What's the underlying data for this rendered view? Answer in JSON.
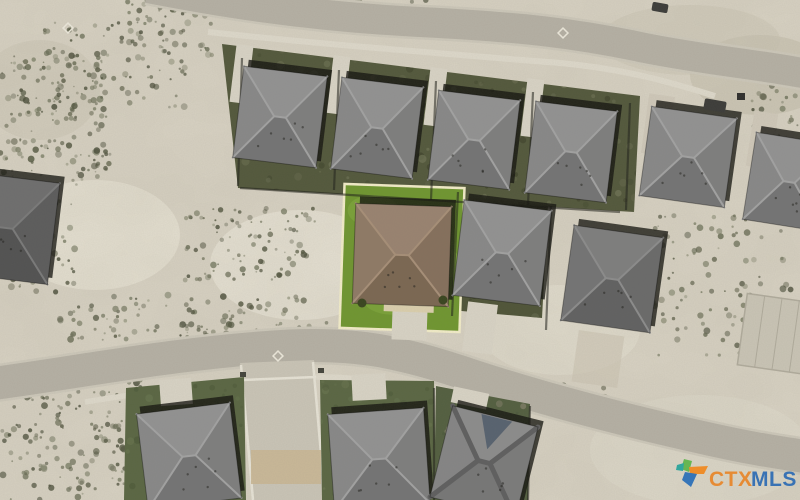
{
  "watermark": {
    "ctx": "CTX",
    "mls": "MLS",
    "ctx_color": "#e8862a",
    "mls_color": "#2e6cb4",
    "logo": {
      "green": "#5fb54a",
      "orange": "#f0891f",
      "blue": "#2a6fb8",
      "teal": "#27a39b"
    }
  },
  "palette": {
    "sand": "#d8d2c3",
    "road": "#b5b0a4",
    "road_edge": "#ccc7b9",
    "sidewalk": "#ddd8ca",
    "driveway": "#d8d3c5",
    "patio": "#dbcfad",
    "side_street": "#c9c4b6",
    "side_street_dirt": "#c9b795",
    "fence": "#20201a",
    "shadow": "#14140f",
    "slab": "#c9c4b5",
    "slab_line": "#b0ab9c",
    "lot_outline": "#f2ecc8",
    "lawn_highlight": "#6f9630",
    "lawn_highlight_light": "#84ab3f",
    "scrub_colors": [
      "#6b6e57",
      "#575a44",
      "#7a7d65",
      "#4b4e3a"
    ],
    "roofs": {
      "gray": {
        "n": "#929292",
        "e": "#7e7e7e",
        "s": "#747474",
        "w": "#888888",
        "ridge": "#a2a2a2",
        "ridge_w": 2
      },
      "brown": {
        "n": "#998370",
        "e": "#85705c",
        "s": "#7b6752",
        "w": "#8f7a66",
        "ridge": "#a78f78",
        "ridge_w": 2
      },
      "dark": {
        "n": "#6e6e6e",
        "e": "#5c5c5c",
        "s": "#525252",
        "w": "#666666",
        "ridge": "#7a7a7a",
        "ridge_w": 2
      },
      "dark2": {
        "n": "#7e7e7e",
        "e": "#6a6a6a",
        "s": "#616161",
        "w": "#747474",
        "ridge": "#8c8c8c",
        "ridge_w": 2
      },
      "b3": {
        "n": "#8c8c8c",
        "e": "#7b7b7b",
        "s": "#777777",
        "w": "#858585",
        "ridge": "#5f5f5f",
        "ridge_w": 5
      }
    }
  },
  "scene": {
    "shadow_offset": {
      "dx": 4,
      "dy": -7
    },
    "sand_patches": [
      {
        "cx": 95,
        "cy": 235,
        "rx": 85,
        "ry": 55,
        "fill": "#e5e0d2",
        "op": 0.9
      },
      {
        "cx": 300,
        "cy": 265,
        "rx": 90,
        "ry": 55,
        "fill": "#e8e3d5",
        "op": 0.85
      },
      {
        "cx": 430,
        "cy": 120,
        "rx": 60,
        "ry": 35,
        "fill": "#e0dbcd",
        "op": 0.6
      },
      {
        "cx": 690,
        "cy": 40,
        "rx": 90,
        "ry": 35,
        "fill": "#cfc9b9",
        "op": 0.8
      },
      {
        "cx": 760,
        "cy": 75,
        "rx": 70,
        "ry": 40,
        "fill": "#c8c1af",
        "op": 0.7
      },
      {
        "cx": 700,
        "cy": 450,
        "rx": 110,
        "ry": 55,
        "fill": "#ddd8c9",
        "op": 0.85
      },
      {
        "cx": 560,
        "cy": 330,
        "rx": 80,
        "ry": 45,
        "fill": "#e2ddcf",
        "op": 0.7
      },
      {
        "cx": 40,
        "cy": 90,
        "rx": 60,
        "ry": 50,
        "fill": "#cdc7b6",
        "op": 0.6
      }
    ],
    "scrub_clusters": [
      {
        "x": 125,
        "y": 0,
        "w": 95,
        "h": 55,
        "n": 55
      },
      {
        "x": 35,
        "y": 22,
        "w": 150,
        "h": 88,
        "n": 90
      },
      {
        "x": 0,
        "y": 55,
        "w": 110,
        "h": 130,
        "n": 160
      },
      {
        "x": 0,
        "y": 180,
        "w": 75,
        "h": 115,
        "n": 65
      },
      {
        "x": 0,
        "y": 378,
        "w": 150,
        "h": 122,
        "n": 160
      },
      {
        "x": 55,
        "y": 295,
        "w": 250,
        "h": 45,
        "n": 85
      },
      {
        "x": 185,
        "y": 208,
        "w": 130,
        "h": 72,
        "n": 95
      },
      {
        "x": 180,
        "y": 322,
        "w": 170,
        "h": 24,
        "n": 50
      },
      {
        "x": 640,
        "y": 215,
        "w": 155,
        "h": 145,
        "n": 115
      },
      {
        "x": 250,
        "y": 0,
        "w": 190,
        "h": 12,
        "n": 28
      },
      {
        "x": 752,
        "y": 84,
        "w": 46,
        "h": 52,
        "n": 26
      },
      {
        "x": 540,
        "y": 385,
        "w": 70,
        "h": 40,
        "n": 25
      }
    ],
    "roads": {
      "top": {
        "d": "M 148,-12 C 210,0 300,16 420,22 C 520,27 575,33 645,48 C 705,60 755,64 808,74",
        "w": 30
      },
      "top_sidewalk": {
        "d": "M 208,32 C 330,45 460,55 560,63 C 625,69 670,82 715,96",
        "w": 6
      },
      "bottom": {
        "d": "M -10,384 C 80,372 180,352 290,346 C 360,343 400,352 470,375 C 540,398 620,419 700,437 C 752,449 782,453 808,457",
        "w": 33
      },
      "bottom_sidewalk": {
        "d": "M 85,402 C 170,388 250,379 320,377 C 380,377 432,390 478,406",
        "w": 5.5
      }
    },
    "side_street": {
      "points": "240,363 314,360 326,500 252,500",
      "edge_left": [
        241,
        365,
        253,
        500
      ],
      "edge_right": [
        313,
        362,
        325,
        500
      ],
      "crossing": [
        242,
        380,
        316,
        377
      ],
      "dirt": {
        "x": 251,
        "y": 450,
        "w": 70,
        "h": 34
      }
    },
    "lawns": [
      {
        "points": "222,44 640,96 634,212 238,188",
        "fill": "#53583c",
        "n": 220,
        "mottle": [
          "#62664a",
          "#41452d",
          "#6e7254"
        ]
      },
      {
        "points": "456,196 548,205 542,318 450,310",
        "fill": "#4f5438",
        "n": 55,
        "mottle": [
          "#62664a",
          "#41452d"
        ]
      },
      {
        "points": "126,388 244,377 246,500 124,500",
        "fill": "#5a6643",
        "n": 60,
        "mottle": [
          "#4e5a39",
          "#67734e"
        ]
      },
      {
        "points": "320,380 434,381 436,500 322,500",
        "fill": "#5a6643",
        "n": 60,
        "mottle": [
          "#4e5a39",
          "#67734e"
        ]
      },
      {
        "points": "436,386 530,404 528,500 434,500",
        "fill": "#535f40",
        "n": 45,
        "mottle": [
          "#47533a",
          "#8b8570"
        ]
      }
    ],
    "highlighted_lot": {
      "x": 342,
      "y": 186,
      "w": 120,
      "h": 144,
      "rot": 2,
      "light_patches": [
        {
          "cx": 372,
          "cy": 212,
          "rx": 26,
          "ry": 16
        },
        {
          "cx": 432,
          "cy": 262,
          "rx": 30,
          "ry": 18
        },
        {
          "cx": 392,
          "cy": 302,
          "rx": 26,
          "ry": 13
        }
      ]
    },
    "driveways": [
      {
        "x": 233,
        "y": 45,
        "w": 17,
        "h": 58,
        "rot": 7
      },
      {
        "x": 330,
        "y": 56,
        "w": 17,
        "h": 58,
        "rot": 7
      },
      {
        "x": 427,
        "y": 68,
        "w": 17,
        "h": 58,
        "rot": 7
      },
      {
        "x": 524,
        "y": 79,
        "w": 17,
        "h": 58,
        "rot": 7
      },
      {
        "x": 645,
        "y": 95,
        "w": 26,
        "h": 60,
        "rot": 8,
        "fill": "#cfc8b9"
      },
      {
        "x": 750,
        "y": 112,
        "w": 24,
        "h": 56,
        "rot": 9,
        "fill": "#cfc8b9"
      },
      {
        "x": 392,
        "y": 310,
        "w": 35,
        "h": 30,
        "rot": 2
      },
      {
        "x": 465,
        "y": 303,
        "w": 30,
        "h": 50,
        "rot": 7
      },
      {
        "x": 575,
        "y": 333,
        "w": 46,
        "h": 52,
        "rot": 8,
        "fill": "#cbc3b2",
        "op": 0.65
      },
      {
        "x": 160,
        "y": 379,
        "w": 32,
        "h": 26,
        "rot": -4
      },
      {
        "x": 352,
        "y": 374,
        "w": 34,
        "h": 26,
        "rot": -3
      },
      {
        "x": 452,
        "y": 390,
        "w": 36,
        "h": 16,
        "rot": 12
      }
    ],
    "patio": {
      "x": 384,
      "y": 290,
      "w": 50,
      "h": 22,
      "rot": 2
    },
    "fences": [
      [
        339,
        70,
        334,
        190
      ],
      [
        436,
        81,
        431,
        200
      ],
      [
        533,
        92,
        528,
        205
      ],
      [
        630,
        103,
        626,
        210
      ],
      [
        242,
        58,
        238,
        186
      ],
      [
        240,
        188,
        620,
        212
      ],
      [
        458,
        192,
        452,
        316
      ],
      [
        551,
        206,
        546,
        330
      ],
      [
        434,
        388,
        434,
        500
      ],
      [
        530,
        406,
        528,
        500
      ]
    ],
    "slab": {
      "x": 742,
      "y": 298,
      "w": 70,
      "h": 72,
      "rot": 8
    },
    "houses": [
      {
        "id": "top-1",
        "cx": 280,
        "cy": 117,
        "w": 84,
        "h": 92,
        "rot": 7,
        "roof": "gray"
      },
      {
        "id": "top-2",
        "cx": 377,
        "cy": 128,
        "w": 82,
        "h": 92,
        "rot": 7,
        "roof": "gray"
      },
      {
        "id": "top-3",
        "cx": 474,
        "cy": 140,
        "w": 82,
        "h": 90,
        "rot": 7,
        "roof": "gray"
      },
      {
        "id": "top-4",
        "cx": 571,
        "cy": 152,
        "w": 82,
        "h": 92,
        "rot": 7,
        "roof": "gray"
      },
      {
        "id": "top-5",
        "cx": 688,
        "cy": 157,
        "w": 86,
        "h": 90,
        "rot": 8,
        "roof": "gray"
      },
      {
        "id": "top-6",
        "cx": 789,
        "cy": 182,
        "w": 80,
        "h": 88,
        "rot": 9,
        "roof": "gray"
      },
      {
        "id": "left-partial",
        "cx": 6,
        "cy": 228,
        "w": 96,
        "h": 102,
        "rot": 7,
        "roof": "dark"
      },
      {
        "id": "subject",
        "cx": 402,
        "cy": 255,
        "w": 96,
        "h": 100,
        "rot": 2,
        "roof": "brown"
      },
      {
        "id": "mid-right-1",
        "cx": 502,
        "cy": 253,
        "w": 88,
        "h": 96,
        "rot": 7,
        "roof": "gray"
      },
      {
        "id": "mid-right-2",
        "cx": 612,
        "cy": 279,
        "w": 90,
        "h": 96,
        "rot": 8,
        "roof": "dark2"
      },
      {
        "id": "bottom-1",
        "cx": 189,
        "cy": 456,
        "w": 94,
        "h": 96,
        "rot": -7,
        "roof": "gray"
      },
      {
        "id": "bottom-2",
        "cx": 379,
        "cy": 459,
        "w": 96,
        "h": 96,
        "rot": -4,
        "roof": "gray"
      },
      {
        "id": "bottom-3",
        "cx": 484,
        "cy": 462,
        "w": 88,
        "h": 94,
        "rot": 14,
        "roof": "b3",
        "gable": "#57626f"
      }
    ],
    "objects": {
      "cars": [
        {
          "x": 652,
          "y": 3,
          "w": 16,
          "h": 9,
          "rot": 10
        },
        {
          "x": 704,
          "y": 100,
          "w": 22,
          "h": 11,
          "rot": 10
        }
      ],
      "bins": [
        {
          "x": 737,
          "y": 93,
          "w": 8,
          "h": 7
        }
      ],
      "bushes": [
        {
          "cx": 362,
          "cy": 303,
          "r": 4.5
        },
        {
          "cx": 443,
          "cy": 300,
          "r": 4.5
        }
      ],
      "boxes": [
        {
          "x": 240,
          "y": 372,
          "w": 6,
          "h": 5
        },
        {
          "x": 318,
          "y": 368,
          "w": 6,
          "h": 5
        }
      ],
      "diamonds": [
        {
          "x": 68,
          "y": 28
        },
        {
          "x": 563,
          "y": 33
        },
        {
          "x": 278,
          "y": 356
        }
      ]
    }
  }
}
